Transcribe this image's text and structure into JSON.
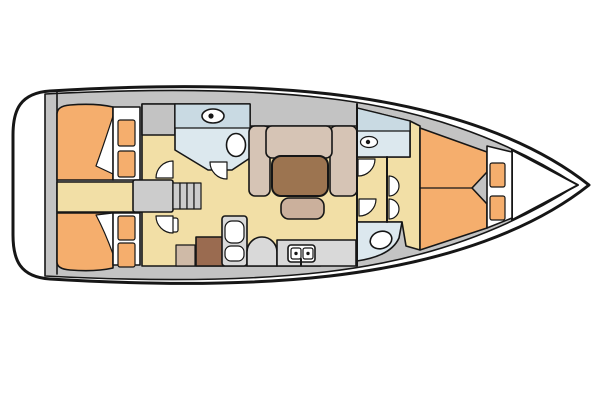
{
  "image": {
    "kind": "yacht-interior-deck-plan",
    "orientation": "bow-right",
    "width": 600,
    "height": 400
  },
  "colors": {
    "line": "#161616",
    "white": "#ffffff",
    "deck_gray": "#c3c3c3",
    "unit_gray": "#d9d9d9",
    "step_gray": "#cccccc",
    "floor_cream": "#f2dfa6",
    "berth_orange": "#f5ae6d",
    "wetroom_blue": "#dce8ee",
    "wetroom_counter_blue": "#c9dae3",
    "settee_taupe": "#d6c4b5",
    "table_brown": "#9c7450",
    "bench_tan": "#cbb09c",
    "cabinet_brown": "#9a6b50",
    "cabinet_tan": "#cfbaa7"
  },
  "rooms": [
    {
      "id": "transom-platform"
    },
    {
      "id": "aft-cabin-port"
    },
    {
      "id": "aft-cabin-starboard"
    },
    {
      "id": "companionway-steps"
    },
    {
      "id": "aft-head"
    },
    {
      "id": "saloon"
    },
    {
      "id": "galley"
    },
    {
      "id": "nav-station"
    },
    {
      "id": "forward-head"
    },
    {
      "id": "forward-shower-room"
    },
    {
      "id": "forward-cabin-v-berth"
    },
    {
      "id": "anchor-locker"
    }
  ],
  "fixtures": {
    "vanity_sinks": 2,
    "galley_sink_bowls": 2,
    "toilets": 2,
    "double_berths": 3,
    "stove_burners": 2,
    "door_swings": 7,
    "companionway_steps": 4
  }
}
